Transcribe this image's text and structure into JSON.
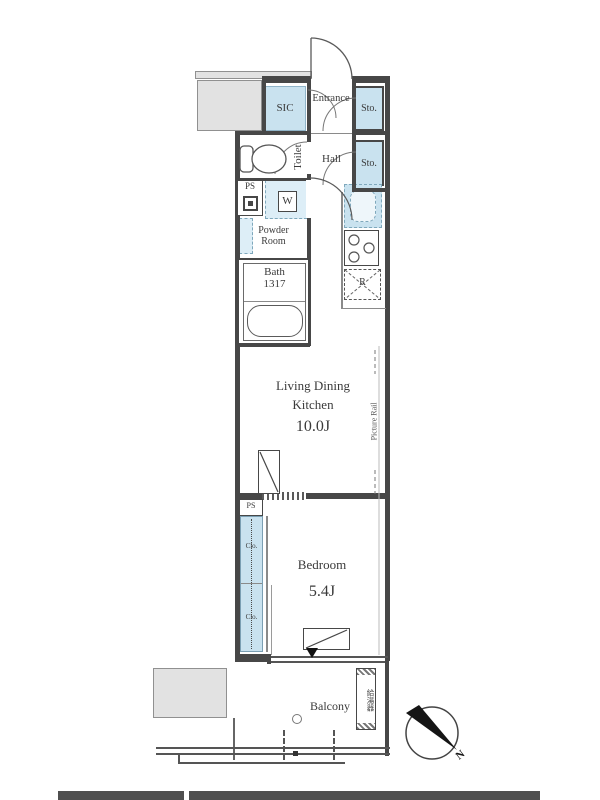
{
  "labels": {
    "sic": "SIC",
    "entrance": "Entrance",
    "sto_entrance": "Sto.",
    "sto_hall": "Sto.",
    "toilet": "Toilet",
    "hall": "Hall",
    "ps_upper": "PS",
    "washer": "W",
    "powder1": "Powder",
    "powder2": "Room",
    "bath": "Bath",
    "bath_size": "1317",
    "fridge": "R",
    "ldk1": "Living Dining",
    "ldk2": "Kitchen",
    "ldk_size": "10.0J",
    "picture_rail": "Picture Rail",
    "ps_lower": "PS",
    "clo_upper": "Clo.",
    "clo_lower": "Clo.",
    "bedroom": "Bedroom",
    "bedroom_size": "5.4J",
    "balcony": "Balcony",
    "water_heater": "給湯器",
    "north": "N"
  },
  "colors": {
    "wall": "#474747",
    "fixture_blue": "#c9e2ef",
    "neighbor_gray": "#e2e2e2"
  }
}
